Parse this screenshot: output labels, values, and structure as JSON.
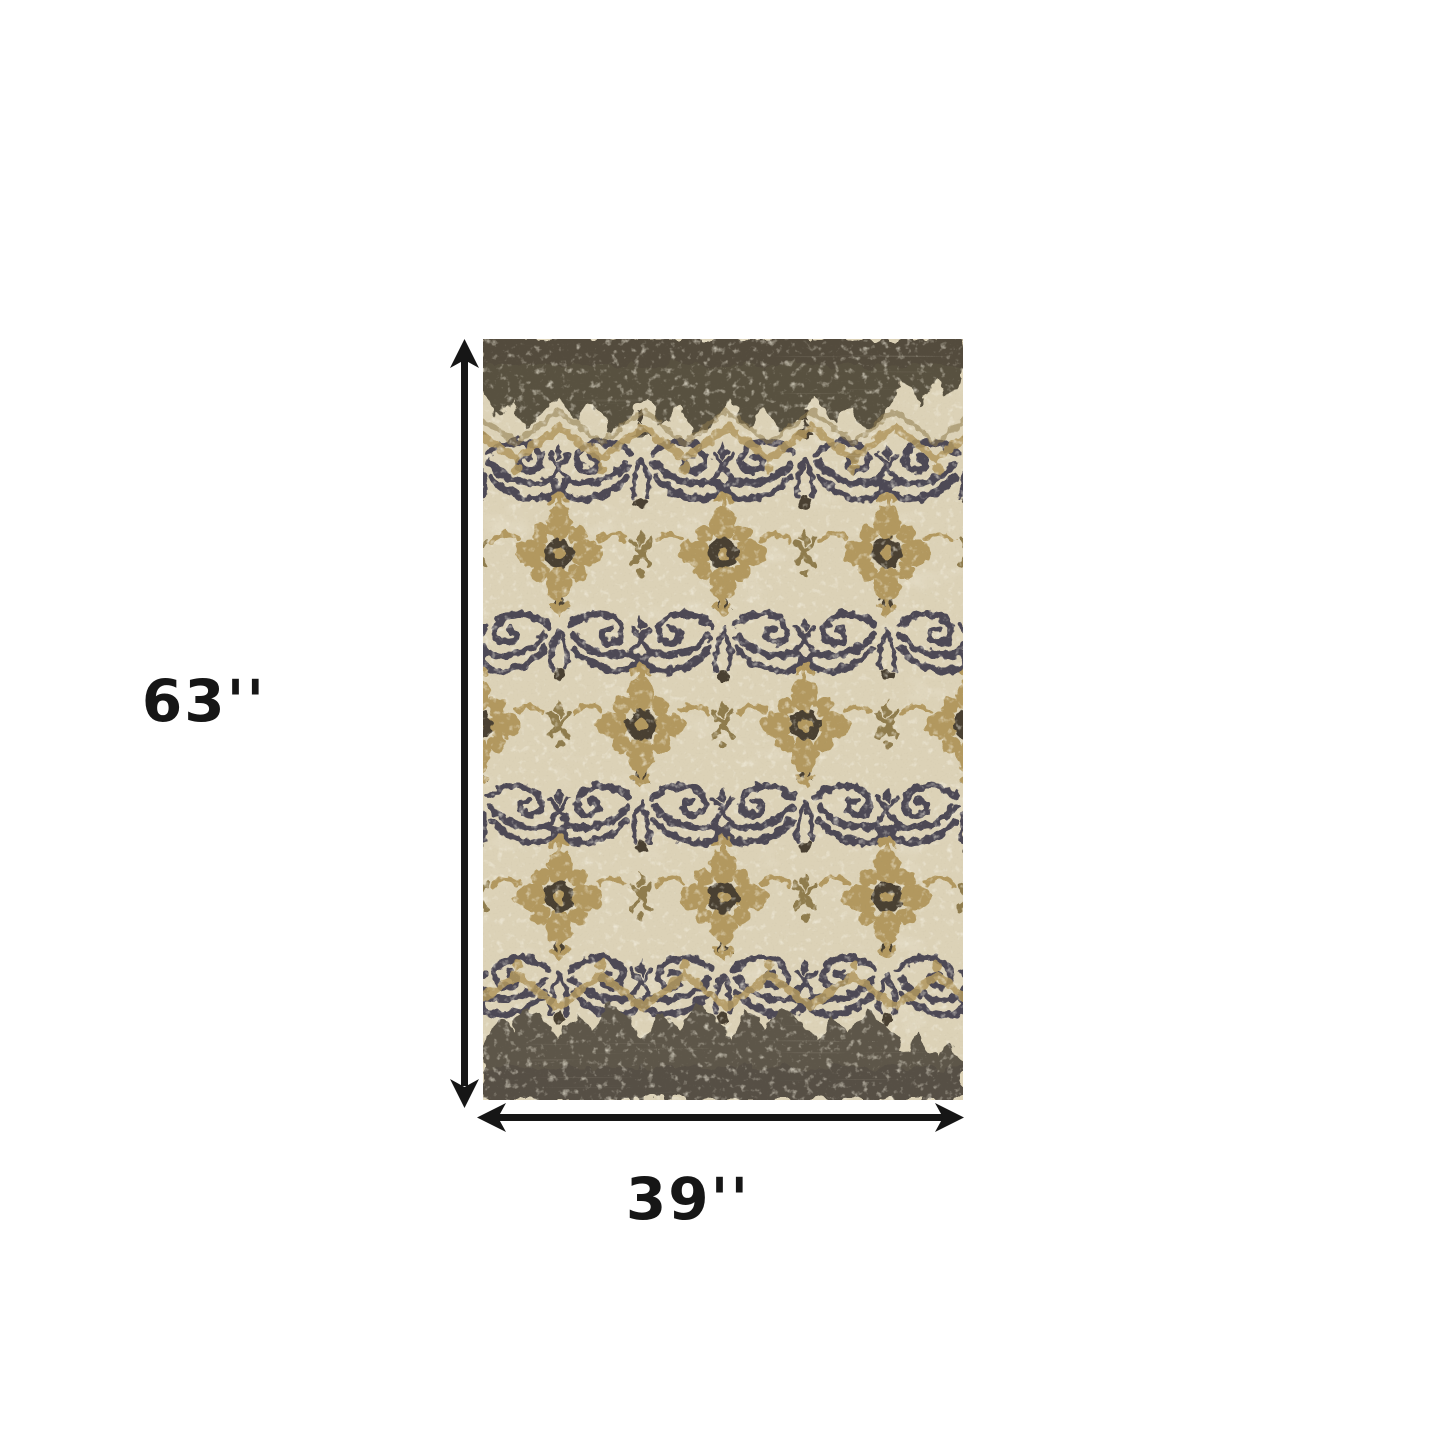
{
  "diagram": {
    "type": "product-dimension-diagram",
    "product": "distressed vintage damask area rug",
    "height_label": "63''",
    "width_label": "39''"
  },
  "colors": {
    "page_bg": "#ffffff",
    "dimension": "#161616",
    "rug_field": "#dcd2b7",
    "rug_field_light": "#e8e0cb",
    "rug_band_top": "#595140",
    "rug_band_bottom": "#5d574a",
    "rug_gold": "#b2985f",
    "rug_gold_dark": "#8f7b4e",
    "rug_navy": "#4e4954",
    "rug_brown": "#4a4033"
  }
}
